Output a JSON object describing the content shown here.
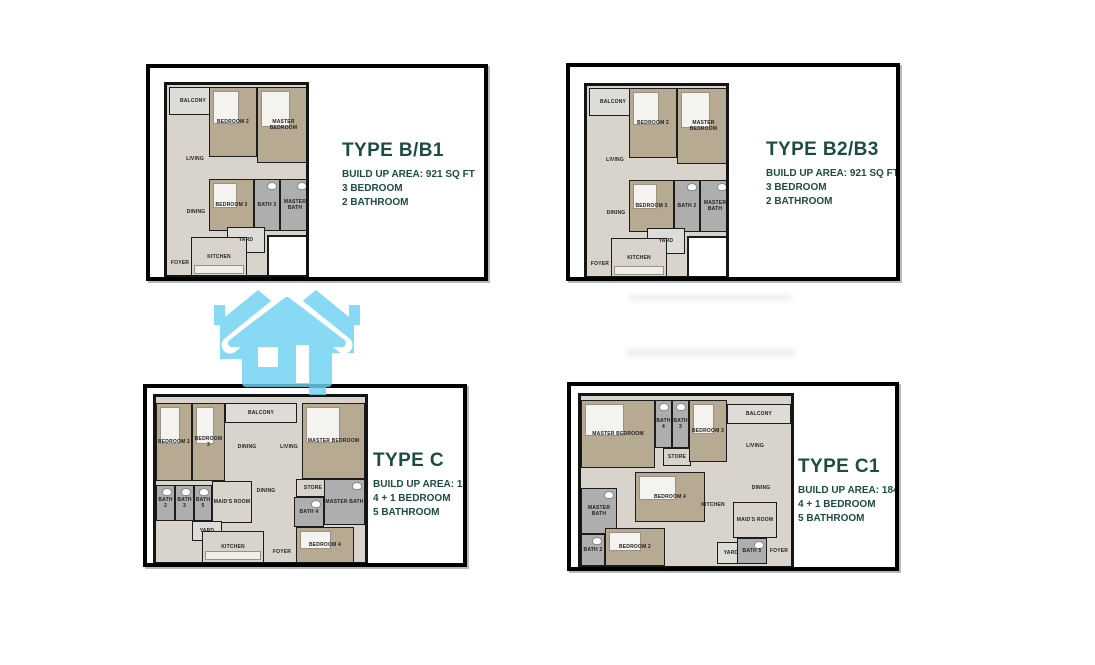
{
  "colors": {
    "accent_text": "#1d4c43",
    "panel_border": "#000000",
    "bedroom_fill": "#b6aa92",
    "bath_fill": "#aeaeae",
    "floor_fill": "#d8d4cc",
    "watermark_blue": "#7ed8f3"
  },
  "watermark": {
    "icon": "house-trio-icon",
    "color": "#7ed8f3"
  },
  "panels": [
    {
      "title": "TYPE B/B1",
      "line1": "BUILD UP AREA: 921 SQ FT",
      "line2": "3 BEDROOM",
      "line3": "2 BATHROOM",
      "plan": {
        "rooms": [
          {
            "label": "BALCONY",
            "kind": "light",
            "l": 2,
            "t": 2,
            "w": 48,
            "h": 28
          },
          {
            "label": "BEDROOM 2",
            "kind": "tan",
            "l": 42,
            "t": 2,
            "w": 48,
            "h": 70
          },
          {
            "label": "MASTER BEDROOM",
            "kind": "tan",
            "l": 90,
            "t": 2,
            "w": 53,
            "h": 76
          },
          {
            "label": "LIVING",
            "kind": "open",
            "l": 4,
            "t": 34,
            "w": 48,
            "h": 80
          },
          {
            "label": "DINING",
            "kind": "open",
            "l": 4,
            "t": 98,
            "w": 50,
            "h": 58
          },
          {
            "label": "BEDROOM 3",
            "kind": "tan",
            "l": 42,
            "t": 94,
            "w": 45,
            "h": 52
          },
          {
            "label": "BATH 2",
            "kind": "bath",
            "l": 87,
            "t": 94,
            "w": 26,
            "h": 52
          },
          {
            "label": "MASTER BATH",
            "kind": "bath",
            "l": 113,
            "t": 94,
            "w": 30,
            "h": 52
          },
          {
            "label": "YARD",
            "kind": "light",
            "l": 60,
            "t": 142,
            "w": 38,
            "h": 26
          },
          {
            "label": "KITCHEN",
            "kind": "kitchen",
            "l": 24,
            "t": 152,
            "w": 56,
            "h": 40
          },
          {
            "label": "FOYER",
            "kind": "open",
            "l": 0,
            "t": 164,
            "w": 26,
            "h": 28
          },
          {
            "label": "",
            "kind": "cut",
            "l": 100,
            "t": 150,
            "w": 45,
            "h": 46
          }
        ]
      }
    },
    {
      "title": "TYPE B2/B3",
      "line1": "BUILD UP AREA: 921 SQ FT",
      "line2": "3 BEDROOM",
      "line3": "2 BATHROOM",
      "plan": {
        "rooms": [
          {
            "label": "BALCONY",
            "kind": "light",
            "l": 2,
            "t": 2,
            "w": 48,
            "h": 28
          },
          {
            "label": "BEDROOM 2",
            "kind": "tan",
            "l": 42,
            "t": 2,
            "w": 48,
            "h": 70
          },
          {
            "label": "MASTER BEDROOM",
            "kind": "tan",
            "l": 90,
            "t": 2,
            "w": 53,
            "h": 76
          },
          {
            "label": "LIVING",
            "kind": "open",
            "l": 4,
            "t": 34,
            "w": 48,
            "h": 80
          },
          {
            "label": "DINING",
            "kind": "open",
            "l": 4,
            "t": 98,
            "w": 50,
            "h": 58
          },
          {
            "label": "BEDROOM 3",
            "kind": "tan",
            "l": 42,
            "t": 94,
            "w": 45,
            "h": 52
          },
          {
            "label": "BATH 2",
            "kind": "bath",
            "l": 87,
            "t": 94,
            "w": 26,
            "h": 52
          },
          {
            "label": "MASTER BATH",
            "kind": "bath",
            "l": 113,
            "t": 94,
            "w": 30,
            "h": 52
          },
          {
            "label": "YARD",
            "kind": "light",
            "l": 60,
            "t": 142,
            "w": 38,
            "h": 26
          },
          {
            "label": "KITCHEN",
            "kind": "kitchen",
            "l": 24,
            "t": 152,
            "w": 56,
            "h": 40
          },
          {
            "label": "FOYER",
            "kind": "open",
            "l": 0,
            "t": 164,
            "w": 26,
            "h": 28
          },
          {
            "label": "",
            "kind": "cut",
            "l": 100,
            "t": 150,
            "w": 45,
            "h": 46
          }
        ]
      }
    },
    {
      "title": "TYPE C",
      "line1": "BUILD UP AREA: 1842 SQ FT",
      "line2": "4 + 1 BEDROOM",
      "line3": "5 BATHROOM",
      "plan": {
        "rooms": [
          {
            "label": "BEDROOM 2",
            "kind": "tan",
            "l": 0,
            "t": 6,
            "w": 36,
            "h": 78
          },
          {
            "label": "BEDROOM 3",
            "kind": "tan",
            "l": 36,
            "t": 6,
            "w": 33,
            "h": 78
          },
          {
            "label": "BALCONY",
            "kind": "light",
            "l": 69,
            "t": 6,
            "w": 72,
            "h": 20
          },
          {
            "label": "DINING",
            "kind": "open",
            "l": 69,
            "t": 26,
            "w": 44,
            "h": 48
          },
          {
            "label": "LIVING",
            "kind": "open",
            "l": 113,
            "t": 26,
            "w": 40,
            "h": 48
          },
          {
            "label": "MASTER BEDROOM",
            "kind": "tan",
            "l": 146,
            "t": 6,
            "w": 63,
            "h": 76
          },
          {
            "label": "BATH 2",
            "kind": "bath",
            "l": 0,
            "t": 88,
            "w": 19,
            "h": 36
          },
          {
            "label": "BATH 3",
            "kind": "bath",
            "l": 19,
            "t": 88,
            "w": 19,
            "h": 36
          },
          {
            "label": "BATH 5",
            "kind": "bath",
            "l": 38,
            "t": 88,
            "w": 18,
            "h": 36
          },
          {
            "label": "MAID'S ROOM",
            "kind": "floor",
            "l": 56,
            "t": 84,
            "w": 40,
            "h": 42
          },
          {
            "label": "DINING",
            "kind": "open",
            "l": 88,
            "t": 76,
            "w": 44,
            "h": 36
          },
          {
            "label": "STORE",
            "kind": "floor",
            "l": 140,
            "t": 82,
            "w": 34,
            "h": 18
          },
          {
            "label": "BATH 4",
            "kind": "bath",
            "l": 138,
            "t": 100,
            "w": 30,
            "h": 30
          },
          {
            "label": "MASTER BATH",
            "kind": "bath",
            "l": 168,
            "t": 82,
            "w": 41,
            "h": 46
          },
          {
            "label": "YARD",
            "kind": "light",
            "l": 36,
            "t": 124,
            "w": 30,
            "h": 20
          },
          {
            "label": "KITCHEN",
            "kind": "kitchen",
            "l": 46,
            "t": 134,
            "w": 62,
            "h": 32
          },
          {
            "label": "FOYER",
            "kind": "open",
            "l": 108,
            "t": 144,
            "w": 36,
            "h": 22
          },
          {
            "label": "BEDROOM 4",
            "kind": "tan",
            "l": 140,
            "t": 130,
            "w": 58,
            "h": 36
          }
        ]
      }
    },
    {
      "title": "TYPE C1",
      "line1": "BUILD UP AREA: 1842 SQ FT",
      "line2": "4 + 1 BEDROOM",
      "line3": "5 BATHROOM",
      "plan": {
        "rooms": [
          {
            "label": "MASTER BEDROOM",
            "kind": "tan",
            "l": 0,
            "t": 4,
            "w": 74,
            "h": 68
          },
          {
            "label": "BATH 4",
            "kind": "bath",
            "l": 74,
            "t": 4,
            "w": 17,
            "h": 48
          },
          {
            "label": "BATH 3",
            "kind": "bath",
            "l": 91,
            "t": 4,
            "w": 17,
            "h": 48
          },
          {
            "label": "STORE",
            "kind": "floor",
            "l": 82,
            "t": 52,
            "w": 28,
            "h": 18
          },
          {
            "label": "BEDROOM 3",
            "kind": "tan",
            "l": 108,
            "t": 4,
            "w": 38,
            "h": 62
          },
          {
            "label": "BALCONY",
            "kind": "light",
            "l": 146,
            "t": 8,
            "w": 64,
            "h": 20
          },
          {
            "label": "LIVING",
            "kind": "open",
            "l": 146,
            "t": 28,
            "w": 56,
            "h": 44
          },
          {
            "label": "DINING",
            "kind": "open",
            "l": 158,
            "t": 76,
            "w": 44,
            "h": 32
          },
          {
            "label": "KITCHEN",
            "kind": "open",
            "l": 108,
            "t": 96,
            "w": 48,
            "h": 26
          },
          {
            "label": "BEDROOM 4",
            "kind": "tan",
            "l": 54,
            "t": 76,
            "w": 70,
            "h": 50
          },
          {
            "label": "MASTER BATH",
            "kind": "bath",
            "l": 0,
            "t": 92,
            "w": 36,
            "h": 46
          },
          {
            "label": "BATH 2",
            "kind": "bath",
            "l": 0,
            "t": 138,
            "w": 24,
            "h": 32
          },
          {
            "label": "BEDROOM 2",
            "kind": "tan",
            "l": 24,
            "t": 132,
            "w": 60,
            "h": 38
          },
          {
            "label": "YARD",
            "kind": "light",
            "l": 136,
            "t": 146,
            "w": 28,
            "h": 22
          },
          {
            "label": "MAID'S ROOM",
            "kind": "floor",
            "l": 152,
            "t": 106,
            "w": 44,
            "h": 36
          },
          {
            "label": "BATH 5",
            "kind": "bath",
            "l": 156,
            "t": 142,
            "w": 30,
            "h": 26
          },
          {
            "label": "FOYER",
            "kind": "open",
            "l": 186,
            "t": 140,
            "w": 24,
            "h": 30
          }
        ]
      }
    }
  ]
}
